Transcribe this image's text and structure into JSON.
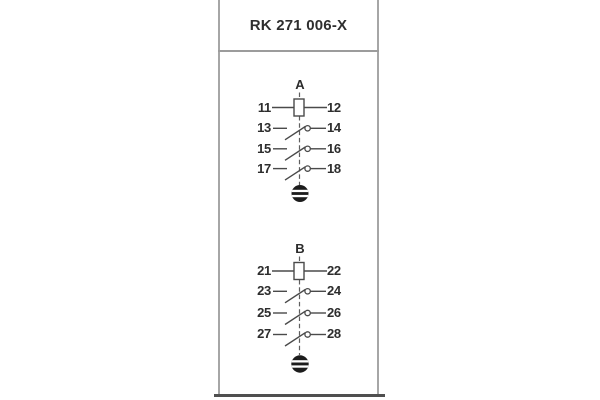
{
  "title": "RK 271 006-X",
  "colors": {
    "background": "#ffffff",
    "card_border": "#a6a6a6",
    "bottom_edge": "#4f4f4f",
    "line": "#4a4a4a",
    "text": "#2d2d2d",
    "disc_fill": "#1c1c1c"
  },
  "schematic": {
    "groups": [
      {
        "label": "A",
        "rows": [
          {
            "left": "11",
            "right": "12",
            "symbol": "coil"
          },
          {
            "left": "13",
            "right": "14",
            "symbol": "make-contact"
          },
          {
            "left": "15",
            "right": "16",
            "symbol": "make-contact"
          },
          {
            "left": "17",
            "right": "18",
            "symbol": "make-contact"
          }
        ],
        "bottom_symbol": "slotted-disc"
      },
      {
        "label": "B",
        "rows": [
          {
            "left": "21",
            "right": "22",
            "symbol": "coil"
          },
          {
            "left": "23",
            "right": "24",
            "symbol": "make-contact"
          },
          {
            "left": "25",
            "right": "26",
            "symbol": "make-contact"
          },
          {
            "left": "27",
            "right": "28",
            "symbol": "make-contact"
          }
        ],
        "bottom_symbol": "slotted-disc"
      }
    ]
  }
}
